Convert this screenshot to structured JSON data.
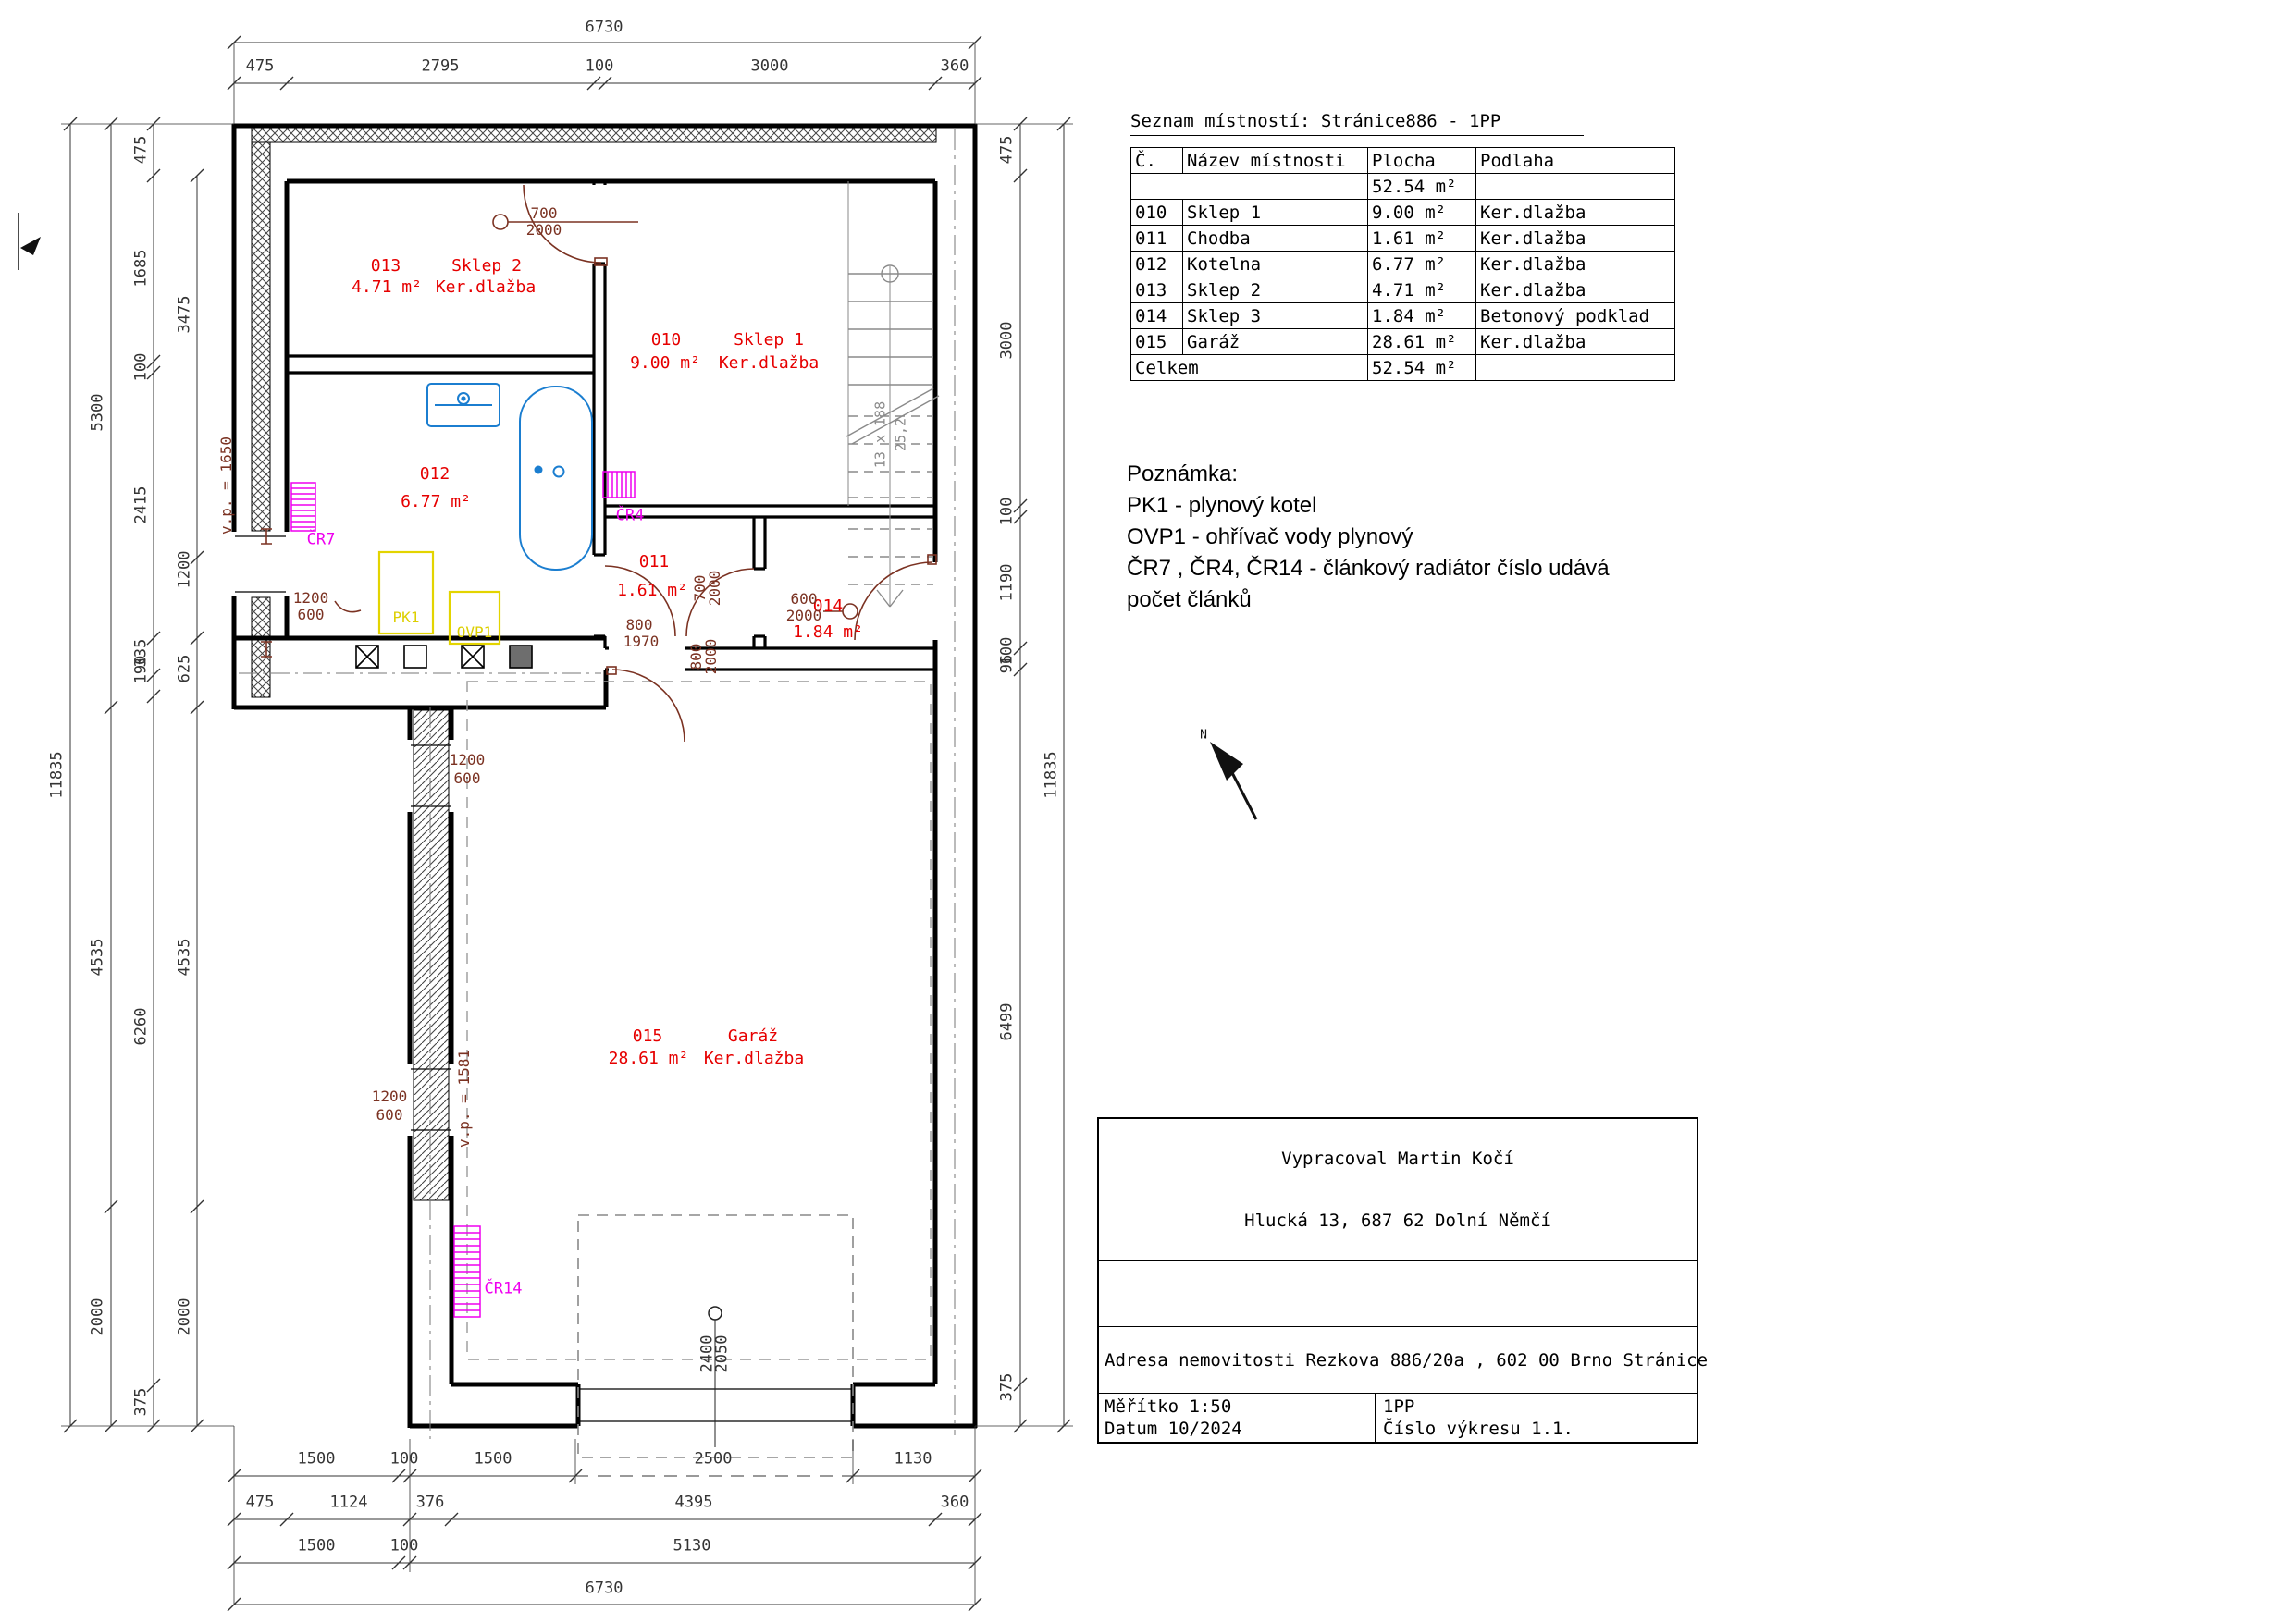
{
  "drawing": {
    "room_list": {
      "title": "Seznam místností: Stránice886 - 1PP",
      "headers": [
        "Č.",
        "Název místnosti",
        "Plocha",
        "Podlaha"
      ],
      "subtotal": [
        "",
        "52.54 m²",
        ""
      ],
      "rows": [
        [
          "010",
          "Sklep 1",
          "9.00 m²",
          "Ker.dlažba"
        ],
        [
          "011",
          "Chodba",
          "1.61 m²",
          "Ker.dlažba"
        ],
        [
          "012",
          "Kotelna",
          "6.77 m²",
          "Ker.dlažba"
        ],
        [
          "013",
          "Sklep 2",
          "4.71 m²",
          "Ker.dlažba"
        ],
        [
          "014",
          "Sklep 3",
          "1.84 m²",
          "Betonový podklad"
        ],
        [
          "015",
          "Garáž",
          "28.61 m²",
          "Ker.dlažba"
        ]
      ],
      "total_label": "Celkem",
      "total": [
        "52.54 m²",
        ""
      ]
    },
    "notes": {
      "title": "Poznámka:",
      "lines": [
        "PK1 - plynový kotel",
        "OVP1 - ohřívač vody plynový",
        "ČR7 , ČR4, ČR14 - článkový radiátor číslo udává",
        "počet článků"
      ]
    },
    "title_block": {
      "author": "Vypracoval Martin Kočí",
      "address": "Hlucká 13, 687 62 Dolní Němčí",
      "property": "Adresa nemovitosti Rezkova 886/20a , 602 00 Brno Stránice",
      "scale": "Měřítko 1:50",
      "date": "Datum 10/2024",
      "floor": "1PP",
      "drawing_no": "Číslo výkresu 1.1."
    },
    "colors": {
      "room_text": "#e60000",
      "door_window_text": "#7b3222",
      "radiator": "#ef00ef",
      "equipment": "#ddcf00",
      "plumbing": "#1b7ed0",
      "dimension_text": "#343434",
      "stairs": "#8a8a8a"
    },
    "labels": [
      [
        "6730",
        653,
        30,
        0,
        "d"
      ],
      [
        "475",
        281,
        72,
        0,
        "d"
      ],
      [
        "2795",
        476,
        72,
        0,
        "d"
      ],
      [
        "100",
        648,
        72,
        0,
        "d"
      ],
      [
        "3000",
        832,
        72,
        0,
        "d"
      ],
      [
        "360",
        1032,
        72,
        0,
        "d"
      ],
      [
        "1500",
        342,
        1578,
        0,
        "d"
      ],
      [
        "100",
        437,
        1578,
        0,
        "d"
      ],
      [
        "1500",
        533,
        1578,
        0,
        "d"
      ],
      [
        "2500",
        771,
        1578,
        0,
        "d"
      ],
      [
        "1130",
        987,
        1578,
        0,
        "d"
      ],
      [
        "475",
        281,
        1625,
        0,
        "d"
      ],
      [
        "1124",
        377,
        1625,
        0,
        "d"
      ],
      [
        "376",
        465,
        1625,
        0,
        "d"
      ],
      [
        "4395",
        750,
        1625,
        0,
        "d"
      ],
      [
        "360",
        1032,
        1625,
        0,
        "d"
      ],
      [
        "1500",
        342,
        1672,
        0,
        "d"
      ],
      [
        "100",
        437,
        1672,
        0,
        "d"
      ],
      [
        "5130",
        748,
        1672,
        0,
        "d"
      ],
      [
        "6730",
        653,
        1718,
        0,
        "d"
      ],
      [
        "11835",
        62,
        838,
        1,
        "d"
      ],
      [
        "5300",
        106,
        446,
        1,
        "d"
      ],
      [
        "4535",
        106,
        1035,
        1,
        "d"
      ],
      [
        "2000",
        106,
        1424,
        1,
        "d"
      ],
      [
        "475",
        153,
        162,
        1,
        "d"
      ],
      [
        "1685",
        153,
        290,
        1,
        "d"
      ],
      [
        "100",
        153,
        397,
        1,
        "d"
      ],
      [
        "2415",
        153,
        546,
        1,
        "d"
      ],
      [
        "335",
        153,
        706,
        1,
        "d"
      ],
      [
        "190",
        153,
        724,
        1,
        "d"
      ],
      [
        "6260",
        153,
        1110,
        1,
        "d"
      ],
      [
        "375",
        153,
        1516,
        1,
        "d"
      ],
      [
        "3475",
        200,
        340,
        1,
        "d"
      ],
      [
        "1200",
        200,
        616,
        1,
        "d"
      ],
      [
        "625",
        200,
        723,
        1,
        "d"
      ],
      [
        "4535",
        200,
        1035,
        1,
        "d"
      ],
      [
        "2000",
        200,
        1424,
        1,
        "d"
      ],
      [
        "475",
        1089,
        162,
        1,
        "d"
      ],
      [
        "3000",
        1089,
        368,
        1,
        "d"
      ],
      [
        "100",
        1089,
        553,
        1,
        "d"
      ],
      [
        "1190",
        1089,
        630,
        1,
        "d"
      ],
      [
        "100",
        1089,
        704,
        1,
        "d"
      ],
      [
        "96",
        1089,
        718,
        1,
        "d"
      ],
      [
        "6499",
        1089,
        1105,
        1,
        "d"
      ],
      [
        "375",
        1089,
        1500,
        1,
        "d"
      ],
      [
        "11835",
        1137,
        838,
        1,
        "d"
      ],
      [
        "2400",
        765,
        1464,
        1,
        "d"
      ],
      [
        "2050",
        781,
        1464,
        1,
        "d"
      ],
      [
        "N",
        1301,
        795,
        0,
        "k"
      ],
      [
        "13 x 188",
        952,
        470,
        1,
        "g"
      ],
      [
        "25,2",
        974,
        470,
        1,
        "g"
      ],
      [
        "013",
        417,
        288,
        0,
        "r"
      ],
      [
        "Sklep 2",
        526,
        288,
        0,
        "r"
      ],
      [
        "4.71 m²",
        418,
        311,
        0,
        "r"
      ],
      [
        "Ker.dlažba",
        525,
        311,
        0,
        "r"
      ],
      [
        "010",
        720,
        368,
        0,
        "r"
      ],
      [
        "Sklep 1",
        831,
        368,
        0,
        "r"
      ],
      [
        "9.00 m²",
        719,
        393,
        0,
        "r"
      ],
      [
        "Ker.dlažba",
        831,
        393,
        0,
        "r"
      ],
      [
        "012",
        470,
        513,
        0,
        "r"
      ],
      [
        "6.77 m²",
        471,
        543,
        0,
        "r"
      ],
      [
        "011",
        707,
        608,
        0,
        "r"
      ],
      [
        "1.61 m²",
        705,
        639,
        0,
        "r"
      ],
      [
        "014",
        895,
        656,
        0,
        "r"
      ],
      [
        "1.84 m²",
        895,
        684,
        0,
        "r"
      ],
      [
        "015",
        700,
        1121,
        0,
        "r"
      ],
      [
        "Garáž",
        814,
        1121,
        0,
        "r"
      ],
      [
        "28.61 m²",
        701,
        1145,
        0,
        "r"
      ],
      [
        "Ker.dlažba",
        815,
        1145,
        0,
        "r"
      ],
      [
        "ČR7",
        347,
        584,
        0,
        "m"
      ],
      [
        "ČR4",
        681,
        558,
        0,
        "m"
      ],
      [
        "ČR14",
        544,
        1394,
        0,
        "m"
      ],
      [
        "PK1",
        439,
        668,
        0,
        "y"
      ],
      [
        "OVP1",
        513,
        684,
        0,
        "y"
      ],
      [
        "700",
        588,
        231,
        0,
        "b"
      ],
      [
        "2000",
        588,
        249,
        0,
        "b"
      ],
      [
        "1200",
        336,
        647,
        0,
        "b"
      ],
      [
        "600",
        336,
        665,
        0,
        "b"
      ],
      [
        "800",
        691,
        676,
        0,
        "b"
      ],
      [
        "1970",
        693,
        694,
        0,
        "b"
      ],
      [
        "700",
        757,
        636,
        1,
        "b"
      ],
      [
        "2000",
        773,
        636,
        1,
        "b"
      ],
      [
        "800",
        753,
        710,
        1,
        "b"
      ],
      [
        "2000",
        769,
        710,
        1,
        "b"
      ],
      [
        "600",
        869,
        648,
        0,
        "b"
      ],
      [
        "2000",
        869,
        666,
        0,
        "b"
      ],
      [
        "1200",
        505,
        822,
        0,
        "b"
      ],
      [
        "600",
        505,
        842,
        0,
        "b"
      ],
      [
        "1200",
        421,
        1186,
        0,
        "b"
      ],
      [
        "600",
        421,
        1206,
        0,
        "b"
      ],
      [
        "v.p. = 1650",
        245,
        525,
        1,
        "b"
      ],
      [
        "v.p. = 1581",
        502,
        1188,
        1,
        "b"
      ]
    ]
  }
}
